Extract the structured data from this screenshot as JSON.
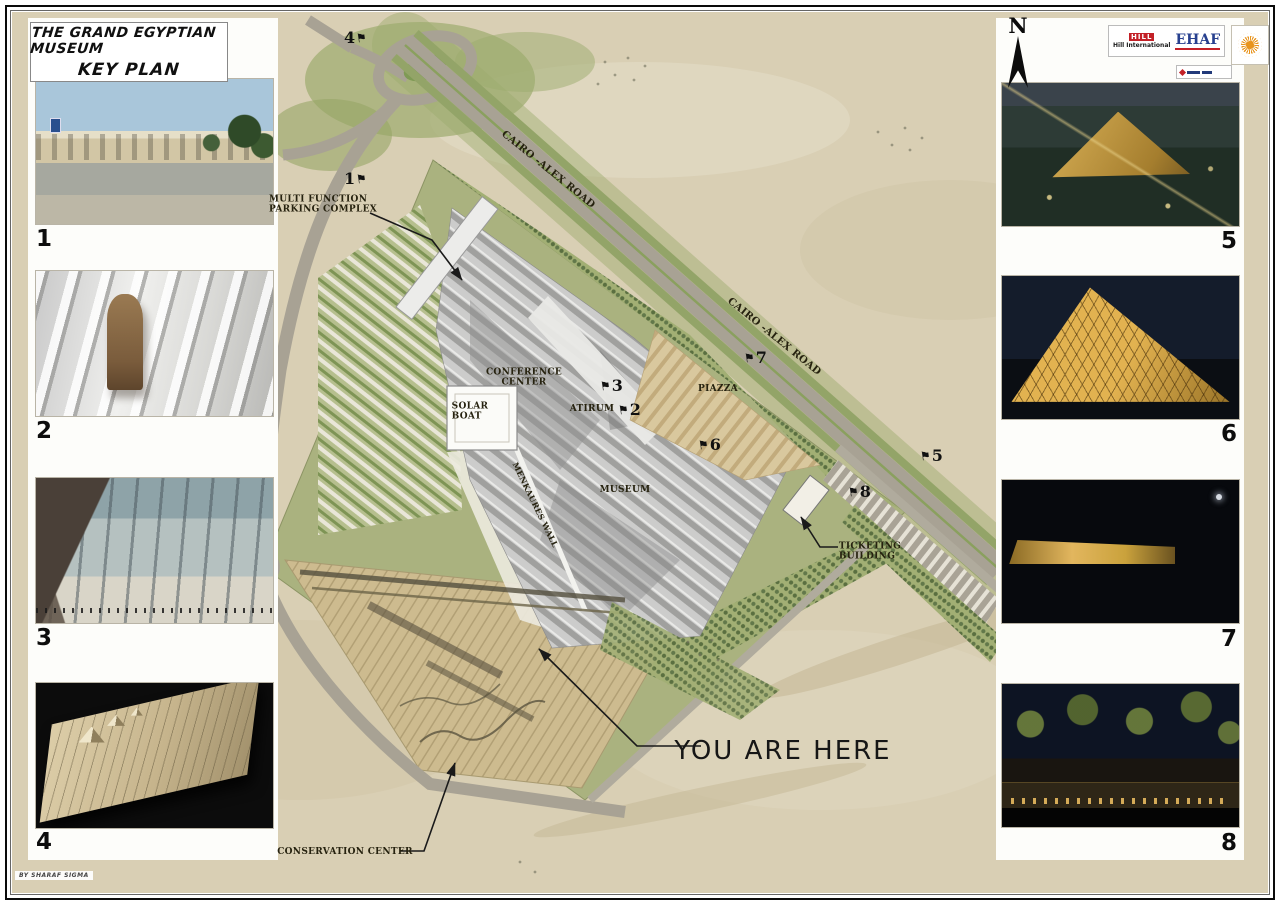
{
  "title": {
    "line1": "THE GRAND EGYPTIAN MUSEUM",
    "line2": "KEY PLAN"
  },
  "north": {
    "label": "N"
  },
  "logos": {
    "hill_block": "HILL",
    "hill_text": "Hill International",
    "ehaf_text": "EHAF"
  },
  "credit": "BY SHARAF SIGMA",
  "you_are_here": "YOU ARE HERE",
  "photos_left": [
    {
      "number": "1"
    },
    {
      "number": "2"
    },
    {
      "number": "3"
    },
    {
      "number": "4"
    }
  ],
  "photos_right": [
    {
      "number": "5"
    },
    {
      "number": "6"
    },
    {
      "number": "7"
    },
    {
      "number": "8"
    }
  ],
  "map_labels": [
    {
      "id": "road-upper",
      "text": "CAIRO -ALEX ROAD",
      "x": 548,
      "y": 170,
      "rot": 39,
      "size": 10
    },
    {
      "id": "road-lower",
      "text": "CAIRO -ALEX ROAD",
      "x": 774,
      "y": 337,
      "rot": 39,
      "size": 10
    },
    {
      "id": "parking",
      "text": "MULTI  FUNCTION\nPARKING COMPLEX",
      "x": 323,
      "y": 205,
      "rot": 0,
      "size": 9,
      "align": "left"
    },
    {
      "id": "conference",
      "text": "CONFERENCE\nCENTER",
      "x": 524,
      "y": 378,
      "rot": 0,
      "size": 9
    },
    {
      "id": "atrium",
      "text": "ATIRUM",
      "x": 592,
      "y": 409,
      "rot": 0,
      "size": 9
    },
    {
      "id": "solar-boat",
      "text": "SOLAR\nBOAT",
      "x": 470,
      "y": 412,
      "rot": 0,
      "size": 9,
      "align": "left"
    },
    {
      "id": "museum",
      "text": "MUSEUM",
      "x": 625,
      "y": 490,
      "rot": 0,
      "size": 9
    },
    {
      "id": "piazza",
      "text": "PIAZZA",
      "x": 718,
      "y": 389,
      "rot": 0,
      "size": 9
    },
    {
      "id": "menkaures-wall",
      "text": "MENKAURES WALL",
      "x": 535,
      "y": 505,
      "rot": 64,
      "size": 8
    },
    {
      "id": "ticketing",
      "text": "TICKETING\nBUILDING",
      "x": 870,
      "y": 552,
      "rot": 0,
      "size": 9,
      "align": "left"
    },
    {
      "id": "conservation",
      "text": "CONSERVATION CENTER",
      "x": 345,
      "y": 852,
      "rot": 0,
      "size": 9
    }
  ],
  "markers": [
    {
      "n": "4",
      "x": 344,
      "y": 31,
      "flag": "right"
    },
    {
      "n": "1",
      "x": 344,
      "y": 172,
      "flag": "right"
    },
    {
      "n": "3",
      "x": 600,
      "y": 379,
      "flag": "left"
    },
    {
      "n": "2",
      "x": 618,
      "y": 403,
      "flag": "left"
    },
    {
      "n": "7",
      "x": 744,
      "y": 351,
      "flag": "left"
    },
    {
      "n": "6",
      "x": 698,
      "y": 438,
      "flag": "left"
    },
    {
      "n": "5",
      "x": 920,
      "y": 449,
      "flag": "left"
    },
    {
      "n": "8",
      "x": 848,
      "y": 485,
      "flag": "left"
    }
  ]
}
